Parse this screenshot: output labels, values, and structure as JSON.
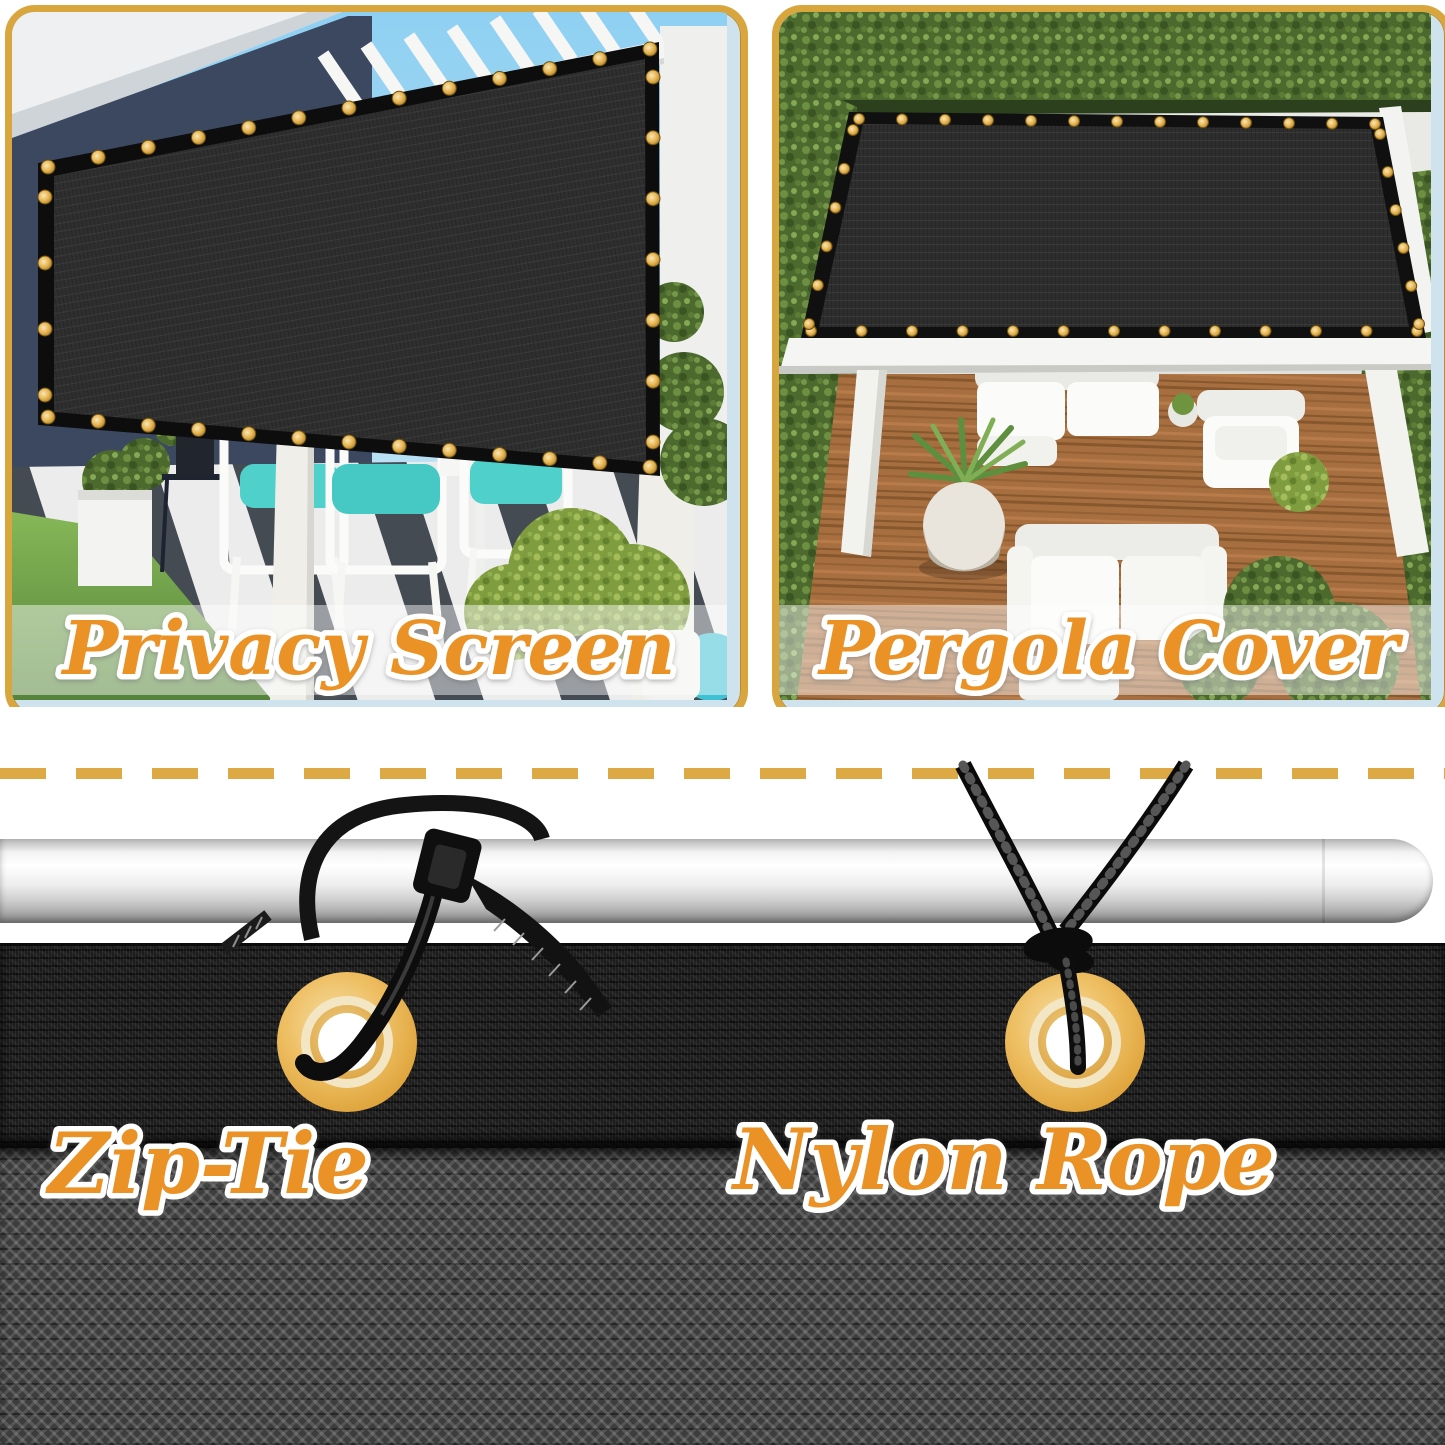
{
  "sections": {
    "privacy_screen": {
      "label": "Privacy Screen"
    },
    "pergola_cover": {
      "label": "Pergola Cover"
    },
    "installation": {
      "zip_tie_label": "Zip-Tie",
      "nylon_rope_label": "Nylon Rope"
    }
  },
  "colors": {
    "panel_border_gold": "#D9A63E",
    "divider_gold": "#DCA944",
    "label_orange": "#EB9227",
    "label_outline": "#FFFFFF",
    "grommet_gold": "#E2AC4C",
    "mesh_dark": "#1F1F1F",
    "pole_silver": "#EDEDED"
  }
}
